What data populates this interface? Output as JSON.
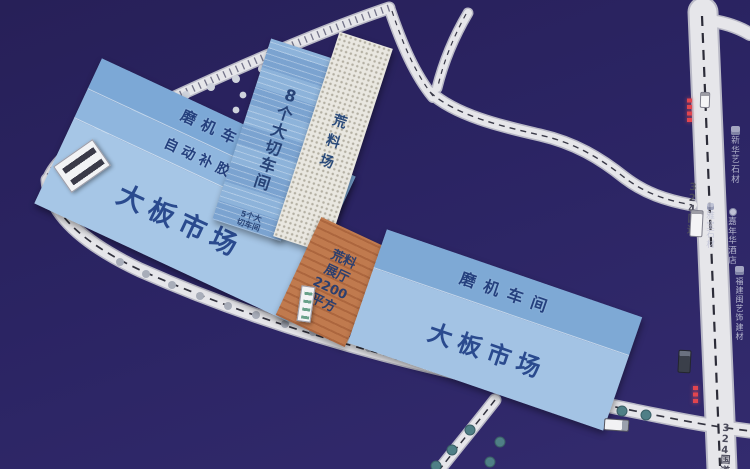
{
  "map": {
    "buildings": {
      "left_complex": {
        "band1": "磨机车间",
        "band2": "自动补胶线",
        "main": "大板市场"
      },
      "cutting8": "8个大切车间",
      "cutting5": "5个大\n切车间",
      "yard": "荒料场",
      "hall": "荒料\n展厅\n2200\n平方",
      "right_complex": {
        "band1": "磨机车间",
        "main": "大板市场"
      }
    },
    "roads": {
      "g324_top": "324国道",
      "g324_bottom": "324国道"
    },
    "poi": [
      {
        "name": "新华艺石材"
      },
      {
        "name": "雅宝石材"
      },
      {
        "name": "嘉年华酒店"
      },
      {
        "name": "福建闽艺饰建材"
      }
    ],
    "colors": {
      "background": "#2b2463",
      "building_blue": "#a6c6e6",
      "band_blue": "#7ca8d6",
      "hall_orange": "#c07a4e",
      "yard_speckle": "#e9e7e0",
      "road": "#e6e6ea",
      "label_blue": "#2a4a8e",
      "red_marker": "#e2454e",
      "tree_teal": "#4f7f86"
    }
  }
}
